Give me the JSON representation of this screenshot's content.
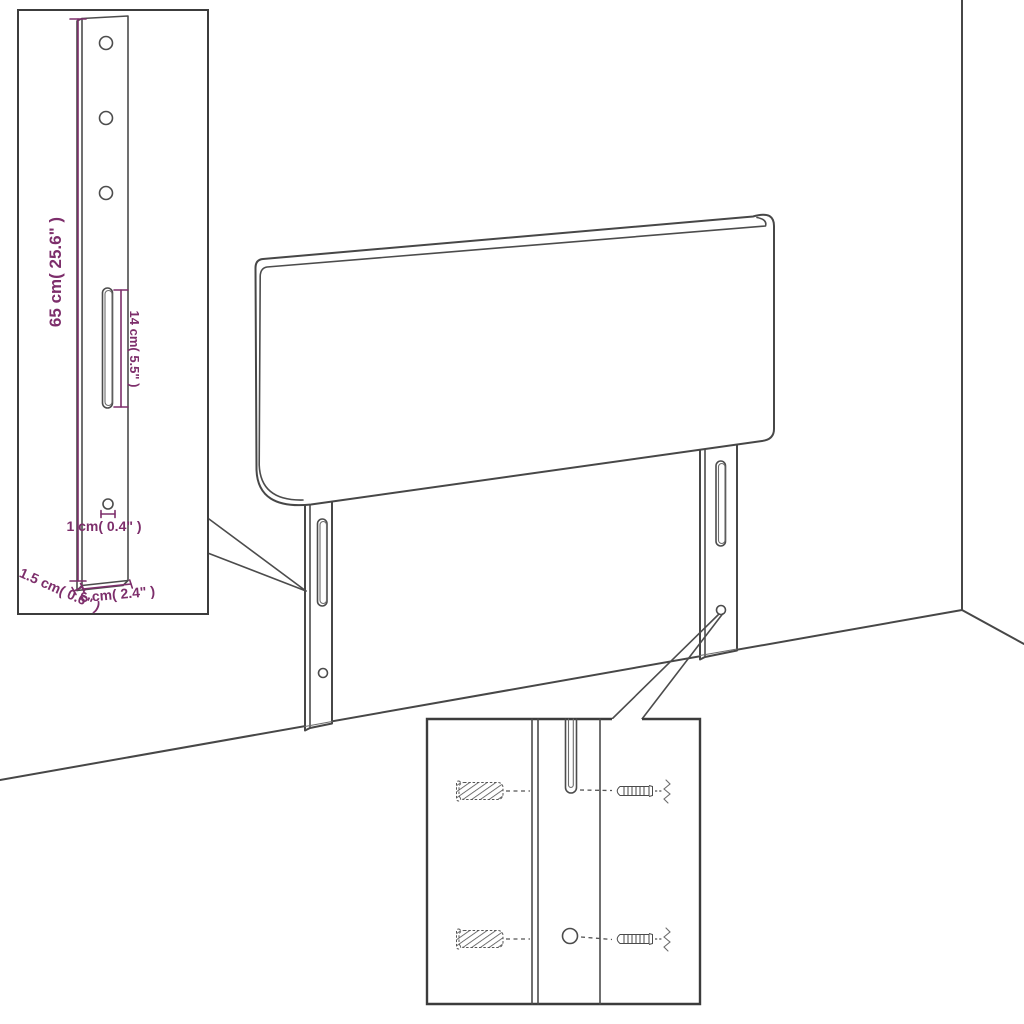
{
  "diagram": {
    "type": "product-dimension-diagram",
    "subject": "upholstered headboard with two slotted mounting legs, wall corner backdrop, leg dimension detail view and wall-plug/screw mounting detail view",
    "colors": {
      "background": "#ffffff",
      "line": "#474747",
      "dimension": "#7d2e6b"
    },
    "leg_detail": {
      "dim_leg_height": "65 cm( 25.6\" )",
      "dim_slot_length": "14 cm( 5.5\" )",
      "dim_hole_diameter": "1 cm( 0.4\" )",
      "dim_leg_thickness": "1.5 cm( 0.6\" )",
      "dim_leg_width": "6 cm( 2.4\" )"
    },
    "mounting_detail": {
      "parts": [
        "wall-plug",
        "wall-plug",
        "screw",
        "screw",
        "slot",
        "round-hole"
      ]
    }
  }
}
